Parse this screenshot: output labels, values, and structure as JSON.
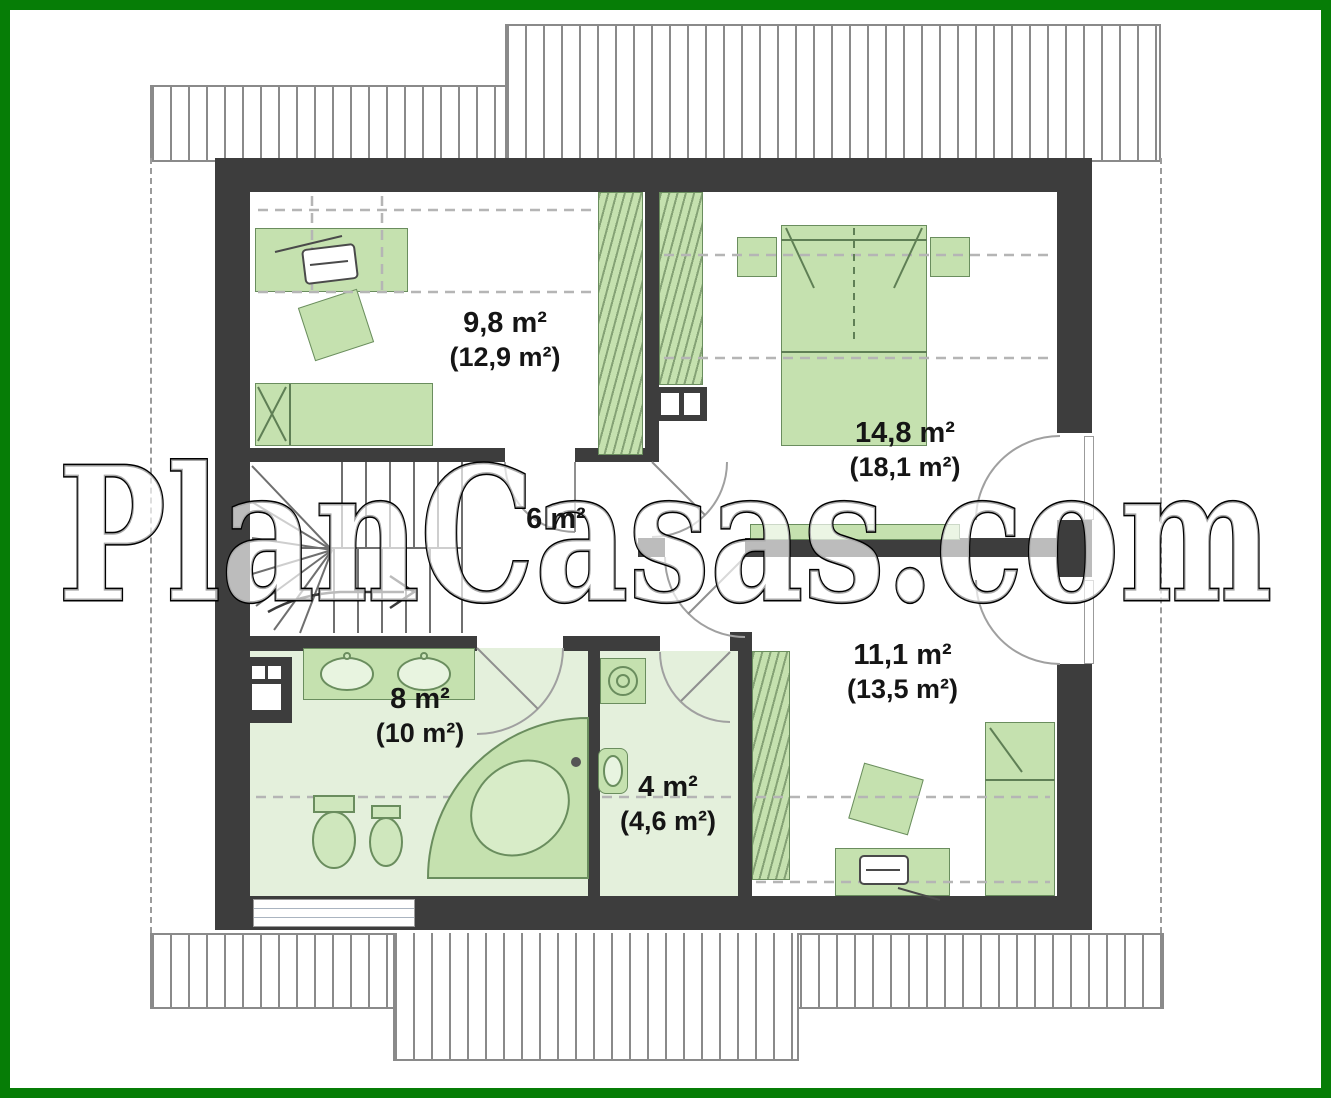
{
  "watermark": {
    "text": "PlanCasas.com"
  },
  "plan": {
    "title_semantics": "attic floor plan with room areas (net and gross in parentheses)",
    "rooms": {
      "room_9_8": {
        "area": "9,8 m²",
        "gross": "(12,9 m²)"
      },
      "room_14_8": {
        "area": "14,8 m²",
        "gross": "(18,1 m²)"
      },
      "hall": {
        "area": "6 m²"
      },
      "bathroom": {
        "area": "8 m²",
        "gross": "(10 m²)"
      },
      "utility": {
        "area": "4 m²",
        "gross": "(4,6 m²)"
      },
      "room_11_1": {
        "area": "11,1 m²",
        "gross": "(13,5 m²)"
      }
    },
    "colors": {
      "frame_green": "#067d06",
      "wall_dark": "#3d3d3d",
      "furniture_green": "#c5e1af",
      "floor_green": "#e4f0dc",
      "hatch_gray": "#8a8a8a"
    }
  }
}
